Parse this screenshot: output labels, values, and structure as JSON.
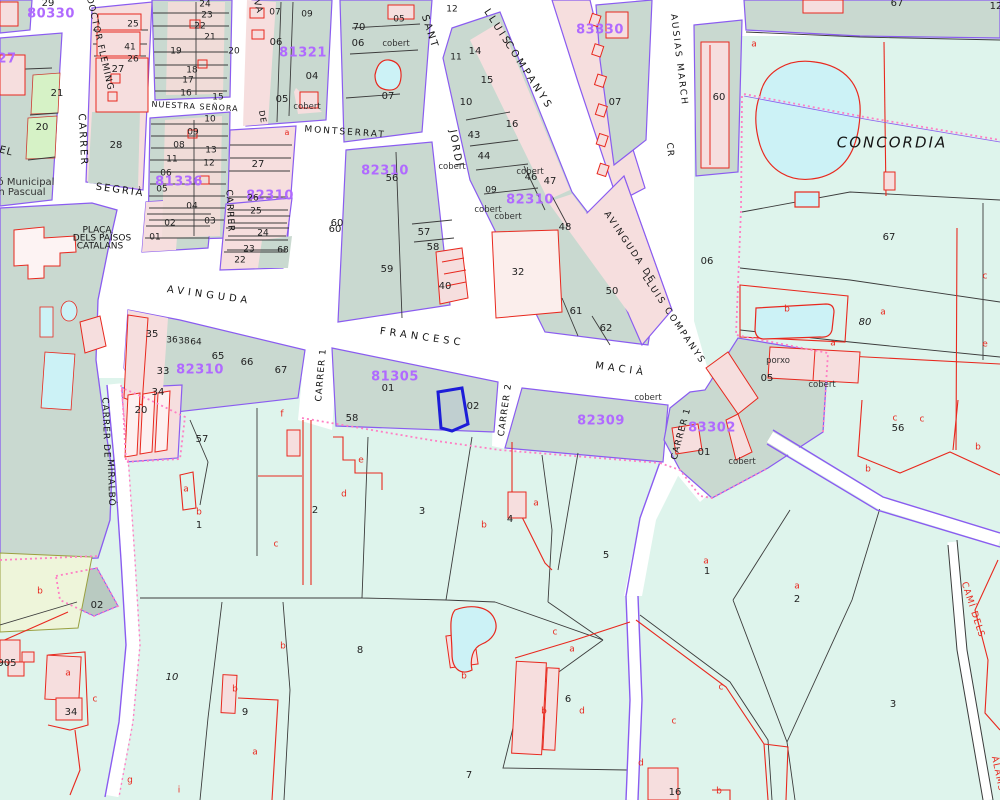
{
  "map": {
    "name": "cadastral-parcel-map",
    "region_label": "CONCORDIA",
    "selected_parcel_block": "81305"
  },
  "colors": {
    "urban_block": "#c9d9d0",
    "rural_parcel": "#def4ec",
    "building_fill": "#f6dede",
    "building_line": "#e8281e",
    "water": "#ccf2f6",
    "boundary_purple": "#8a5cf0",
    "boundary_dotted_pink": "#ff7fc4",
    "selection_blue": "#1d1dd8",
    "block_code_magenta": "#b06aff",
    "parcel_line_black": "#3c3c3c"
  },
  "labels": {
    "block_codes": [
      {
        "t": "80330",
        "x": 51,
        "y": 14,
        "r": 0
      },
      {
        "t": "27",
        "x": 7,
        "y": 59,
        "r": 0
      },
      {
        "t": "81321",
        "x": 303,
        "y": 53,
        "r": 0
      },
      {
        "t": "81336",
        "x": 179,
        "y": 182,
        "r": 0
      },
      {
        "t": "82310",
        "x": 270,
        "y": 196,
        "r": 0
      },
      {
        "t": "82310",
        "x": 385,
        "y": 171,
        "r": 0
      },
      {
        "t": "82310",
        "x": 530,
        "y": 200,
        "r": 0
      },
      {
        "t": "82310",
        "x": 200,
        "y": 370,
        "r": 0
      },
      {
        "t": "81305",
        "x": 395,
        "y": 377,
        "r": 0
      },
      {
        "t": "82309",
        "x": 601,
        "y": 421,
        "r": 0
      },
      {
        "t": "83302",
        "x": 712,
        "y": 428,
        "r": 0
      },
      {
        "t": "83330",
        "x": 600,
        "y": 30,
        "r": 0
      }
    ],
    "streets": [
      {
        "t": "DOCTOR FLEMING",
        "x": 99,
        "y": 44,
        "r": 77,
        "s": 9,
        "sp": 1
      },
      {
        "t": "CARRER",
        "x": 82,
        "y": 140,
        "r": 87,
        "s": 10,
        "sp": 2
      },
      {
        "t": "EL",
        "x": 6,
        "y": 152,
        "r": 15,
        "s": 10,
        "sp": 1
      },
      {
        "t": "SEGRIÀ",
        "x": 120,
        "y": 191,
        "r": 8,
        "s": 10,
        "sp": 2
      },
      {
        "t": "CARRER",
        "x": 229,
        "y": 211,
        "r": 87,
        "s": 9,
        "sp": 1
      },
      {
        "t": "NUESTRA SEÑORA",
        "x": 195,
        "y": 107,
        "r": 3,
        "s": 8,
        "sp": 1
      },
      {
        "t": "DE",
        "x": 262,
        "y": 117,
        "r": 80,
        "s": 8,
        "sp": 1
      },
      {
        "t": "MONTSERRAT",
        "x": 345,
        "y": 133,
        "r": 4,
        "s": 9,
        "sp": 2
      },
      {
        "t": "VA",
        "x": 257,
        "y": 7,
        "r": 75,
        "s": 9,
        "sp": 1
      },
      {
        "t": "SANT",
        "x": 429,
        "y": 32,
        "r": 72,
        "s": 10,
        "sp": 2
      },
      {
        "t": "JORDI",
        "x": 455,
        "y": 149,
        "r": 80,
        "s": 10,
        "sp": 2
      },
      {
        "t": "LLUIS",
        "x": 497,
        "y": 28,
        "r": 57,
        "s": 10,
        "sp": 3
      },
      {
        "t": "COMPANYS",
        "x": 528,
        "y": 76,
        "r": 57,
        "s": 10,
        "sp": 3
      },
      {
        "t": "AUSIAS MARCH",
        "x": 678,
        "y": 60,
        "r": 83,
        "s": 9,
        "sp": 2
      },
      {
        "t": "CR",
        "x": 669,
        "y": 150,
        "r": 85,
        "s": 9,
        "sp": 1
      },
      {
        "t": "AVINGUDA",
        "x": 209,
        "y": 296,
        "r": 8,
        "s": 10,
        "sp": 4
      },
      {
        "t": "FRANCESC",
        "x": 422,
        "y": 338,
        "r": 8,
        "s": 10,
        "sp": 4
      },
      {
        "t": "MACIÀ",
        "x": 621,
        "y": 370,
        "r": 8,
        "s": 10,
        "sp": 4
      },
      {
        "t": "CARRER 1",
        "x": 322,
        "y": 375,
        "r": -85,
        "s": 9,
        "sp": 1
      },
      {
        "t": "CARRER 2",
        "x": 506,
        "y": 410,
        "r": -82,
        "s": 9,
        "sp": 1
      },
      {
        "t": "CARRER 1",
        "x": 682,
        "y": 434,
        "r": -75,
        "s": 9,
        "sp": 1
      },
      {
        "t": "AVINGUDA DE",
        "x": 629,
        "y": 248,
        "r": 56,
        "s": 9,
        "sp": 2
      },
      {
        "t": "LLUIS COMPANYS",
        "x": 673,
        "y": 320,
        "r": 56,
        "s": 9,
        "sp": 2
      },
      {
        "t": "CARRER DE",
        "x": 105,
        "y": 428,
        "r": 88,
        "s": 9,
        "sp": 1
      },
      {
        "t": "MIRALBÓ",
        "x": 110,
        "y": 483,
        "r": 88,
        "s": 9,
        "sp": 1
      },
      {
        "t": "CAMÍ DELS",
        "x": 972,
        "y": 610,
        "r": 72,
        "s": 9,
        "sp": 1,
        "c": "#e8281e"
      },
      {
        "t": "ÀLAMS",
        "x": 997,
        "y": 774,
        "r": 78,
        "s": 9,
        "sp": 1,
        "c": "#e8281e"
      },
      {
        "t": "CONCORDIA",
        "x": 892,
        "y": 143,
        "r": 0,
        "s": 15,
        "sp": 2,
        "i": true
      },
      {
        "t": "PLAÇA",
        "x": 97,
        "y": 231,
        "r": 0,
        "s": 9,
        "sp": 0
      },
      {
        "t": "DELS PAÏSOS",
        "x": 102,
        "y": 239,
        "r": 0,
        "s": 9,
        "sp": 0
      },
      {
        "t": "CATALANS",
        "x": 100,
        "y": 247,
        "r": 0,
        "s": 9,
        "sp": 0
      }
    ],
    "parcel_numbers": [
      {
        "t": "29",
        "x": 48,
        "y": 4
      },
      {
        "t": "25",
        "x": 133,
        "y": 25,
        "s": 9
      },
      {
        "t": "41",
        "x": 130,
        "y": 48,
        "s": 9
      },
      {
        "t": "26",
        "x": 133,
        "y": 60,
        "s": 9
      },
      {
        "t": "27",
        "x": 118,
        "y": 70
      },
      {
        "t": "21",
        "x": 57,
        "y": 94
      },
      {
        "t": "20",
        "x": 42,
        "y": 128
      },
      {
        "t": "28",
        "x": 116,
        "y": 146
      },
      {
        "t": "24",
        "x": 205,
        "y": 5,
        "s": 9
      },
      {
        "t": "23",
        "x": 207,
        "y": 16,
        "s": 9
      },
      {
        "t": "22",
        "x": 200,
        "y": 27,
        "s": 9
      },
      {
        "t": "21",
        "x": 210,
        "y": 38,
        "s": 9
      },
      {
        "t": "19",
        "x": 176,
        "y": 52,
        "s": 9
      },
      {
        "t": "20",
        "x": 234,
        "y": 52,
        "s": 9
      },
      {
        "t": "18",
        "x": 192,
        "y": 71,
        "s": 9
      },
      {
        "t": "17",
        "x": 188,
        "y": 81,
        "s": 9
      },
      {
        "t": "16",
        "x": 186,
        "y": 94,
        "s": 9
      },
      {
        "t": "15",
        "x": 218,
        "y": 98,
        "s": 9
      },
      {
        "t": "10",
        "x": 210,
        "y": 120,
        "s": 9
      },
      {
        "t": "09",
        "x": 193,
        "y": 133,
        "s": 9
      },
      {
        "t": "08",
        "x": 179,
        "y": 146,
        "s": 9
      },
      {
        "t": "11",
        "x": 172,
        "y": 160,
        "s": 9
      },
      {
        "t": "13",
        "x": 211,
        "y": 151,
        "s": 9
      },
      {
        "t": "12",
        "x": 209,
        "y": 164,
        "s": 9
      },
      {
        "t": "06",
        "x": 166,
        "y": 174,
        "s": 9
      },
      {
        "t": "05",
        "x": 162,
        "y": 190,
        "s": 9
      },
      {
        "t": "04",
        "x": 192,
        "y": 207,
        "s": 9
      },
      {
        "t": "03",
        "x": 210,
        "y": 222,
        "s": 9
      },
      {
        "t": "02",
        "x": 170,
        "y": 224,
        "s": 9
      },
      {
        "t": "01",
        "x": 155,
        "y": 238,
        "s": 9
      },
      {
        "t": "07",
        "x": 275,
        "y": 13,
        "s": 9
      },
      {
        "t": "09",
        "x": 307,
        "y": 15,
        "s": 9
      },
      {
        "t": "06",
        "x": 276,
        "y": 43
      },
      {
        "t": "04",
        "x": 312,
        "y": 77
      },
      {
        "t": "05",
        "x": 282,
        "y": 100
      },
      {
        "t": "27",
        "x": 258,
        "y": 165
      },
      {
        "t": "26",
        "x": 253,
        "y": 199,
        "s": 9
      },
      {
        "t": "25",
        "x": 256,
        "y": 212,
        "s": 9
      },
      {
        "t": "24",
        "x": 263,
        "y": 234,
        "s": 9
      },
      {
        "t": "23",
        "x": 249,
        "y": 250,
        "s": 9
      },
      {
        "t": "22",
        "x": 240,
        "y": 261,
        "s": 9
      },
      {
        "t": "68",
        "x": 283,
        "y": 251,
        "s": 9
      },
      {
        "t": "60",
        "x": 335,
        "y": 230
      },
      {
        "t": "70",
        "x": 359,
        "y": 28
      },
      {
        "t": "05",
        "x": 399,
        "y": 20,
        "s": 9
      },
      {
        "t": "06",
        "x": 358,
        "y": 44
      },
      {
        "t": "07",
        "x": 388,
        "y": 97
      },
      {
        "t": "12",
        "x": 452,
        "y": 10,
        "s": 9
      },
      {
        "t": "11",
        "x": 456,
        "y": 58,
        "s": 9
      },
      {
        "t": "14",
        "x": 475,
        "y": 52
      },
      {
        "t": "15",
        "x": 487,
        "y": 81
      },
      {
        "t": "10",
        "x": 466,
        "y": 103
      },
      {
        "t": "16",
        "x": 512,
        "y": 125
      },
      {
        "t": "43",
        "x": 474,
        "y": 136
      },
      {
        "t": "44",
        "x": 484,
        "y": 157
      },
      {
        "t": "09",
        "x": 491,
        "y": 191,
        "s": 9
      },
      {
        "t": "46",
        "x": 531,
        "y": 178
      },
      {
        "t": "47",
        "x": 550,
        "y": 182
      },
      {
        "t": "56",
        "x": 392,
        "y": 179
      },
      {
        "t": "07",
        "x": 615,
        "y": 103
      },
      {
        "t": "60",
        "x": 337,
        "y": 224
      },
      {
        "t": "57",
        "x": 424,
        "y": 233
      },
      {
        "t": "58",
        "x": 433,
        "y": 248
      },
      {
        "t": "59",
        "x": 387,
        "y": 270
      },
      {
        "t": "40",
        "x": 445,
        "y": 287
      },
      {
        "t": "32",
        "x": 518,
        "y": 273
      },
      {
        "t": "48",
        "x": 565,
        "y": 228
      },
      {
        "t": "61",
        "x": 576,
        "y": 312
      },
      {
        "t": "62",
        "x": 606,
        "y": 329
      },
      {
        "t": "50",
        "x": 612,
        "y": 292
      },
      {
        "t": "67",
        "x": 897,
        "y": 4
      },
      {
        "t": "12",
        "x": 996,
        "y": 7
      },
      {
        "t": "60",
        "x": 719,
        "y": 98
      },
      {
        "t": "67",
        "x": 889,
        "y": 238
      },
      {
        "t": "06",
        "x": 707,
        "y": 262
      },
      {
        "t": "05",
        "x": 767,
        "y": 379
      },
      {
        "t": "80",
        "x": 865,
        "y": 323,
        "i": true
      },
      {
        "t": "35",
        "x": 152,
        "y": 335
      },
      {
        "t": "36",
        "x": 172,
        "y": 341,
        "s": 9
      },
      {
        "t": "38",
        "x": 184,
        "y": 342,
        "s": 9
      },
      {
        "t": "64",
        "x": 196,
        "y": 343,
        "s": 9
      },
      {
        "t": "65",
        "x": 218,
        "y": 357
      },
      {
        "t": "66",
        "x": 247,
        "y": 363
      },
      {
        "t": "67",
        "x": 281,
        "y": 371
      },
      {
        "t": "33",
        "x": 163,
        "y": 372
      },
      {
        "t": "34",
        "x": 158,
        "y": 393
      },
      {
        "t": "20",
        "x": 141,
        "y": 411
      },
      {
        "t": "01",
        "x": 388,
        "y": 389
      },
      {
        "t": "02",
        "x": 473,
        "y": 407
      },
      {
        "t": "01",
        "x": 704,
        "y": 453
      },
      {
        "t": "56",
        "x": 898,
        "y": 429
      },
      {
        "t": "57",
        "x": 202,
        "y": 440
      },
      {
        "t": "58",
        "x": 352,
        "y": 419
      },
      {
        "t": "1",
        "x": 199,
        "y": 526
      },
      {
        "t": "2",
        "x": 315,
        "y": 511
      },
      {
        "t": "3",
        "x": 422,
        "y": 512
      },
      {
        "t": "4",
        "x": 510,
        "y": 520
      },
      {
        "t": "5",
        "x": 606,
        "y": 556
      },
      {
        "t": "1",
        "x": 707,
        "y": 572
      },
      {
        "t": "2",
        "x": 797,
        "y": 600
      },
      {
        "t": "3",
        "x": 893,
        "y": 705
      },
      {
        "t": "16",
        "x": 675,
        "y": 793
      },
      {
        "t": "02",
        "x": 97,
        "y": 606
      },
      {
        "t": "10",
        "x": 172,
        "y": 678,
        "i": true
      },
      {
        "t": "34",
        "x": 71,
        "y": 713
      },
      {
        "t": "9",
        "x": 245,
        "y": 713
      },
      {
        "t": "905",
        "x": 7,
        "y": 664
      },
      {
        "t": "8",
        "x": 360,
        "y": 651
      },
      {
        "t": "6",
        "x": 568,
        "y": 700
      },
      {
        "t": "7",
        "x": 469,
        "y": 776
      }
    ],
    "subparcel_letters": [
      {
        "t": "a",
        "x": 754,
        "y": 45
      },
      {
        "t": "b",
        "x": 787,
        "y": 310
      },
      {
        "t": "a",
        "x": 883,
        "y": 313
      },
      {
        "t": "a",
        "x": 833,
        "y": 344
      },
      {
        "t": "c",
        "x": 985,
        "y": 277
      },
      {
        "t": "e",
        "x": 985,
        "y": 345
      },
      {
        "t": "c",
        "x": 922,
        "y": 420
      },
      {
        "t": "f",
        "x": 282,
        "y": 415
      },
      {
        "t": "a",
        "x": 186,
        "y": 490
      },
      {
        "t": "b",
        "x": 199,
        "y": 513
      },
      {
        "t": "c",
        "x": 276,
        "y": 545
      },
      {
        "t": "b",
        "x": 40,
        "y": 592
      },
      {
        "t": "e",
        "x": 361,
        "y": 461
      },
      {
        "t": "d",
        "x": 344,
        "y": 495
      },
      {
        "t": "a",
        "x": 536,
        "y": 504
      },
      {
        "t": "b",
        "x": 484,
        "y": 526
      },
      {
        "t": "a",
        "x": 706,
        "y": 562
      },
      {
        "t": "a",
        "x": 797,
        "y": 587
      },
      {
        "t": "b",
        "x": 868,
        "y": 470
      },
      {
        "t": "c",
        "x": 895,
        "y": 419
      },
      {
        "t": "b",
        "x": 978,
        "y": 448
      },
      {
        "t": "a",
        "x": 68,
        "y": 674
      },
      {
        "t": "c",
        "x": 95,
        "y": 700
      },
      {
        "t": "b",
        "x": 235,
        "y": 690
      },
      {
        "t": "a",
        "x": 255,
        "y": 753
      },
      {
        "t": "b",
        "x": 283,
        "y": 647
      },
      {
        "t": "g",
        "x": 130,
        "y": 781
      },
      {
        "t": "i",
        "x": 179,
        "y": 791
      },
      {
        "t": "b",
        "x": 464,
        "y": 677
      },
      {
        "t": "c",
        "x": 555,
        "y": 633
      },
      {
        "t": "a",
        "x": 572,
        "y": 650
      },
      {
        "t": "b",
        "x": 544,
        "y": 712
      },
      {
        "t": "d",
        "x": 582,
        "y": 712
      },
      {
        "t": "d",
        "x": 641,
        "y": 764
      },
      {
        "t": "c",
        "x": 721,
        "y": 688
      },
      {
        "t": "c",
        "x": 674,
        "y": 722
      },
      {
        "t": "b",
        "x": 719,
        "y": 792
      },
      {
        "t": "a",
        "x": 287,
        "y": 133,
        "s": 8
      }
    ],
    "annotations": [
      {
        "t": "cobert",
        "x": 307,
        "y": 107
      },
      {
        "t": "cobert",
        "x": 396,
        "y": 44
      },
      {
        "t": "cobert",
        "x": 452,
        "y": 167
      },
      {
        "t": "cobert",
        "x": 530,
        "y": 172
      },
      {
        "t": "cobert",
        "x": 488,
        "y": 210
      },
      {
        "t": "cobert",
        "x": 508,
        "y": 217
      },
      {
        "t": "cobert",
        "x": 648,
        "y": 398
      },
      {
        "t": "cobert",
        "x": 822,
        "y": 385
      },
      {
        "t": "cobert",
        "x": 742,
        "y": 462
      },
      {
        "t": "porxo",
        "x": 778,
        "y": 361
      },
      {
        "t": "ó Municipal",
        "x": 26,
        "y": 183,
        "s": 10
      },
      {
        "t": "n Pascual",
        "x": 22,
        "y": 193,
        "s": 10
      }
    ]
  }
}
